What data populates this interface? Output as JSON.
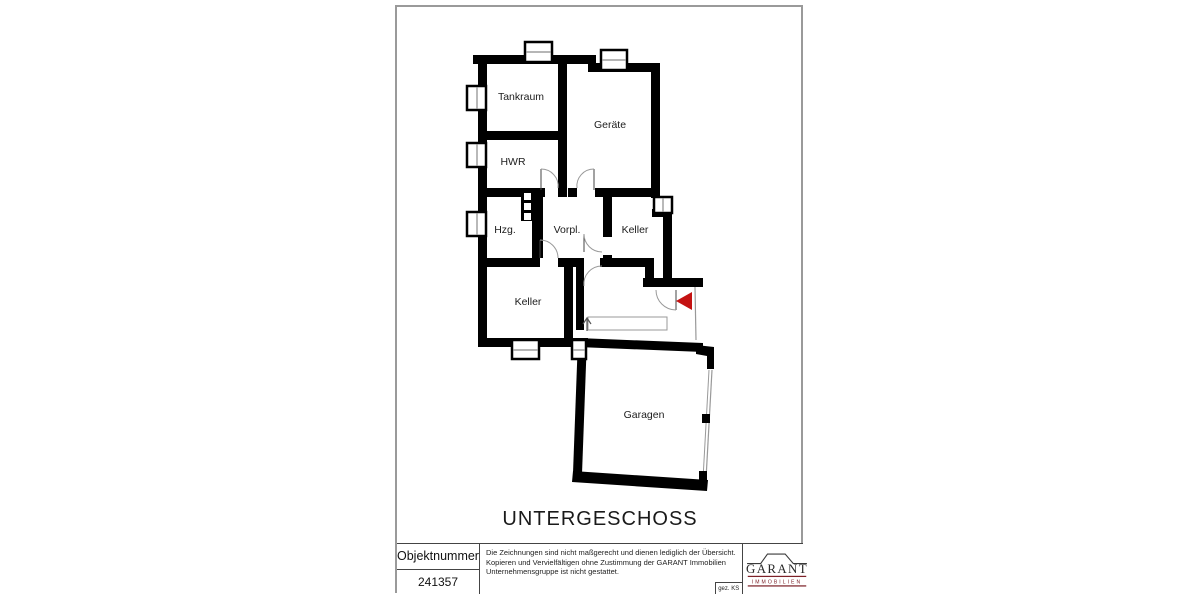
{
  "page": {
    "title": "UNTERGESCHOSS"
  },
  "floorplan": {
    "rooms": {
      "tankraum": "Tankraum",
      "geraete": "Geräte",
      "hwr": "HWR",
      "hzg": "Hzg.",
      "vorpl": "Vorpl.",
      "keller_right": "Keller",
      "keller_bottom": "Keller",
      "garagen": "Garagen"
    },
    "entrance_arrow_color": "#c41212"
  },
  "footer": {
    "object_number_label": "Objektnummer",
    "object_number_value": "241357",
    "disclaimer_line1": "Die Zeichnungen sind nicht maßgerecht und dienen lediglich der Übersicht.",
    "disclaimer_line2": "Kopieren und Vervielfältigen ohne Zustimmung der GARANT Immobilien",
    "disclaimer_line3": "Unternehmensgruppe ist nicht gestattet.",
    "drawn_by": "gez. KS",
    "logo": {
      "name": "GARANT",
      "subtitle": "IMMOBILIEN",
      "accent_color": "#7d2128"
    }
  }
}
